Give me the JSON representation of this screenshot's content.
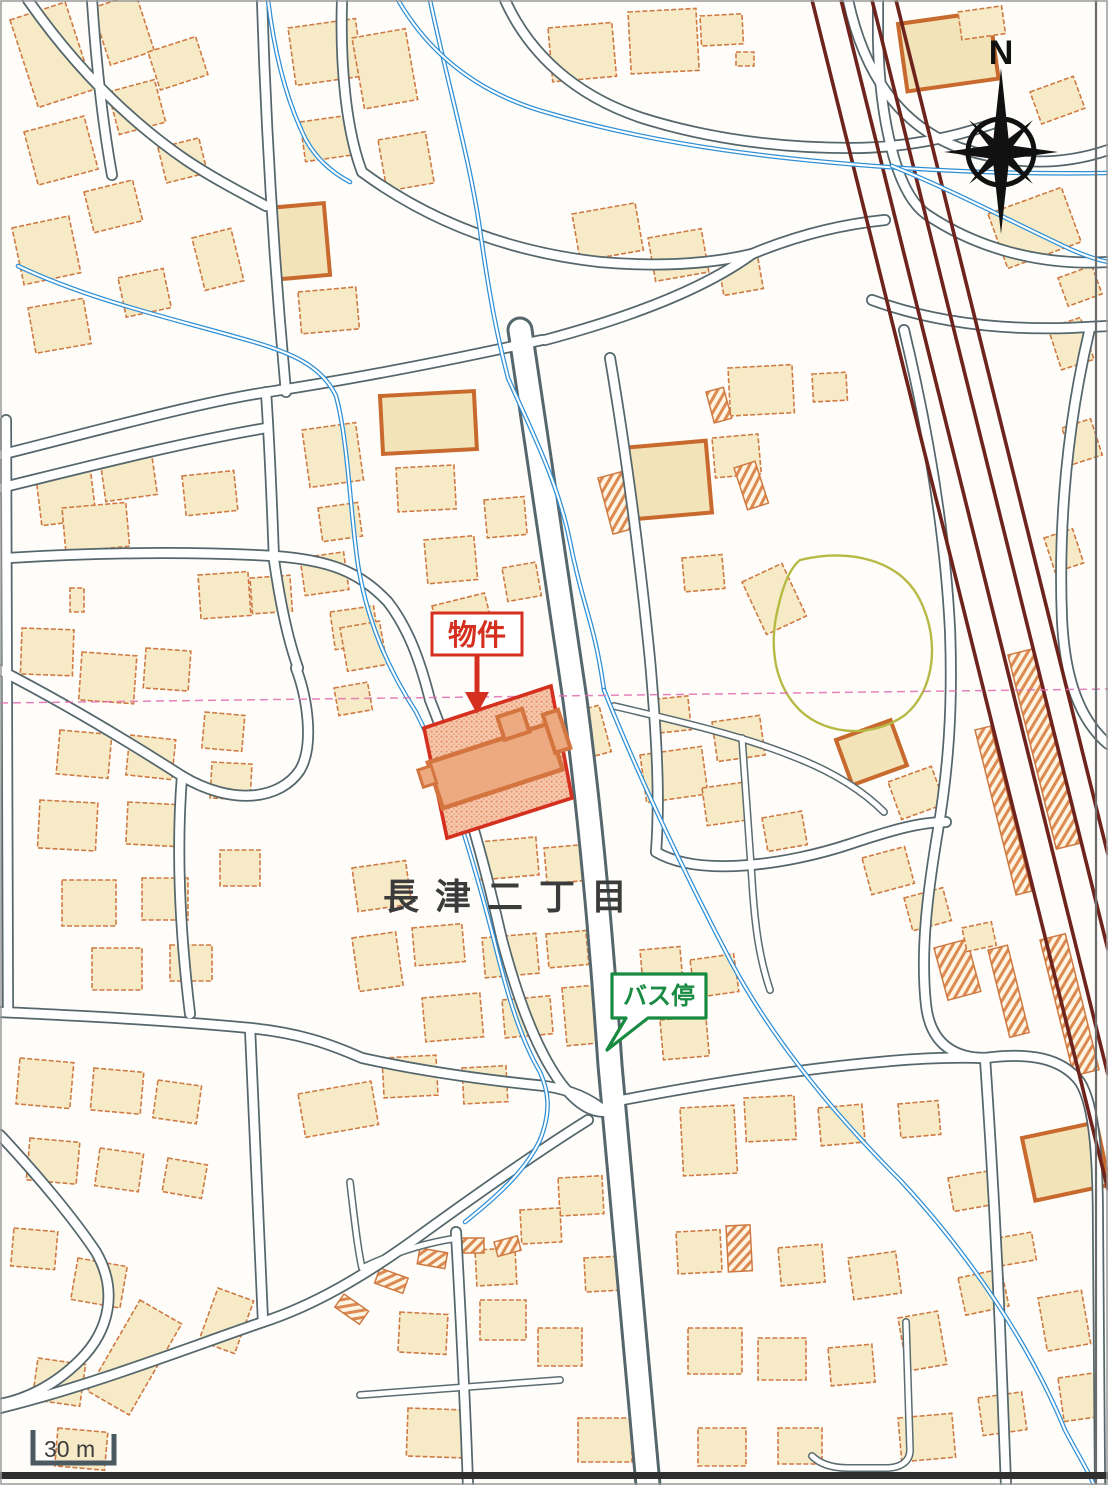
{
  "map": {
    "area_name": "長津二丁目",
    "property_label": "物件",
    "bus_stop_label": "バス停",
    "compass_north": "N",
    "scale_text": "30 m",
    "colors": {
      "background": "#fefdfa",
      "building_fill": "#f6ebc6",
      "building_outline": "#cf7a43",
      "building_outline_bold": "#c8692e",
      "road_casing": "#55676c",
      "water_blue": "#2f8fd5",
      "railway_maroon": "#6e241c",
      "property_red": "#d5301f",
      "property_parcel_fill": "#f6c9ae",
      "bus_stop_green": "#188a41",
      "area_text": "#3b3b3b",
      "park_outline_olive": "#b6ba44",
      "sheet_line_pink": "#e06cb0",
      "compass_black": "#111111",
      "scale_bar_gray": "#4b5a60"
    }
  }
}
